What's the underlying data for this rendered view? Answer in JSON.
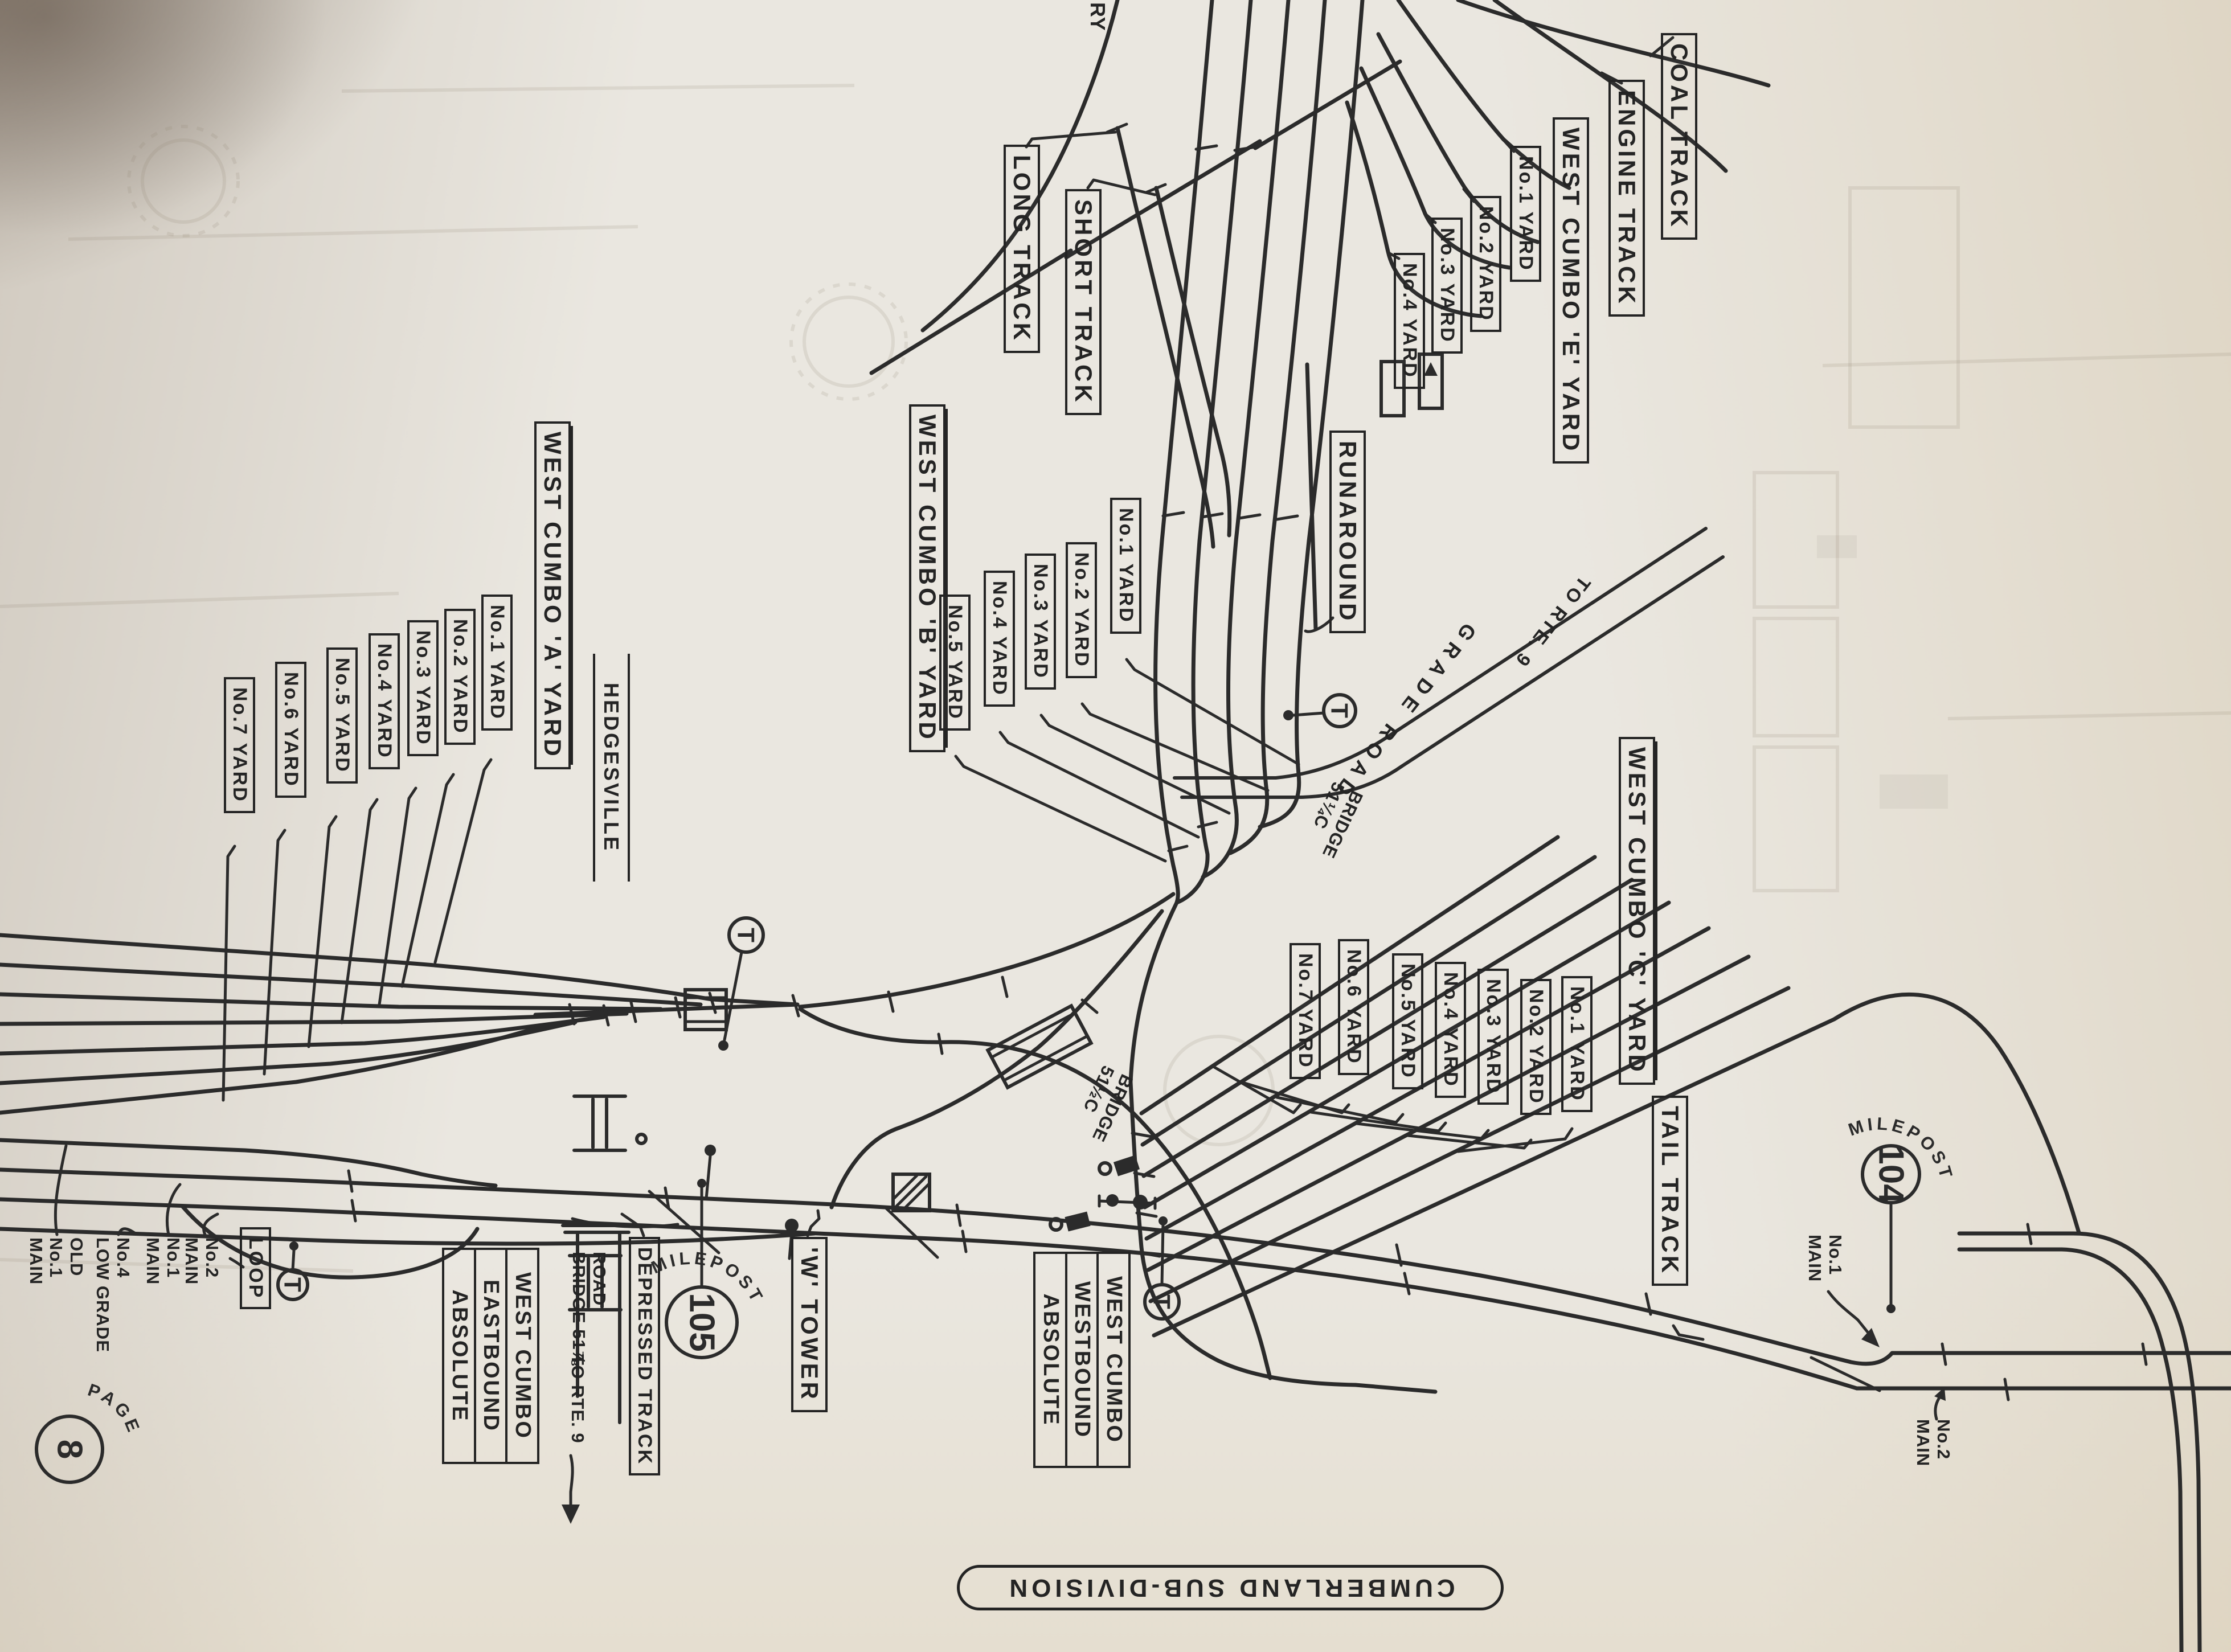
{
  "page": {
    "label": "PAGE",
    "number": "8",
    "banner": "CUMBERLAND SUB-DIVISION",
    "edge_fragment": "RY"
  },
  "symbols": {
    "telephone": "T"
  },
  "mileposts": {
    "mp104": {
      "label": "MILEPOST",
      "number": "104"
    },
    "mp105": {
      "label": "MILEPOST",
      "number": "105"
    }
  },
  "yards": {
    "a": {
      "title": "WEST CUMBO 'A' YARD",
      "tracks": [
        "No.1 YARD",
        "No.2 YARD",
        "No.3 YARD",
        "No.4 YARD",
        "No.5 YARD",
        "No.6 YARD",
        "No.7 YARD"
      ]
    },
    "b": {
      "title": "WEST CUMBO 'B' YARD",
      "tracks": [
        "No.1 YARD",
        "No.2 YARD",
        "No.3 YARD",
        "No.4 YARD",
        "No.5 YARD"
      ]
    },
    "c": {
      "title": "WEST CUMBO 'C' YARD",
      "tracks": [
        "No.1 YARD",
        "No.2 YARD",
        "No.3 YARD",
        "No.4 YARD",
        "No.5 YARD",
        "No.6 YARD",
        "No.7 YARD"
      ]
    },
    "e": {
      "title": "WEST CUMBO 'E' YARD",
      "tracks": [
        "No.1 YARD",
        "No.2 YARD",
        "No.3 YARD",
        "No.4 YARD"
      ]
    }
  },
  "tracks": {
    "coal": "COAL TRACK",
    "engine": "ENGINE TRACK",
    "long": "LONG TRACK",
    "short": "SHORT TRACK",
    "runaround": "RUNAROUND",
    "tail": "TAIL TRACK",
    "depressed": "DEPRESSED TRACK",
    "loop": "LOOP"
  },
  "stations": {
    "hedgesville": "HEDGESVILLE",
    "tower": "'W' TOWER"
  },
  "signals": {
    "westbound": {
      "l1": "WEST CUMBO",
      "l2": "WESTBOUND",
      "l3": "ABSOLUTE"
    },
    "eastbound": {
      "l1": "WEST CUMBO",
      "l2": "EASTBOUND",
      "l3": "ABSOLUTE"
    }
  },
  "mains": {
    "old_no1": {
      "l1": "OLD",
      "l2": "No.1",
      "l3": "MAIN"
    },
    "no4_low_grade": {
      "l1": "No.4",
      "l2": "LOW GRADE"
    },
    "no1_left": {
      "l1": "No.1",
      "l2": "MAIN"
    },
    "no2_left": {
      "l1": "No.2",
      "l2": "MAIN"
    },
    "no1_right": {
      "l1": "No.1",
      "l2": "MAIN"
    },
    "no2_right": {
      "l1": "No.2",
      "l2": "MAIN"
    }
  },
  "roads": {
    "grade_road": "GRADE ROAD",
    "to_rte9_grade": "TO RTE. 9",
    "road_label": {
      "l1": "ROAD",
      "l2": "BRIDGE 51⅞"
    },
    "to_rte9_bridge": "TO RTE. 9"
  },
  "bridges": {
    "b1": {
      "l1": "BRIDGE",
      "l2": "51¼C"
    },
    "b2": {
      "l1": "BRIDGE",
      "l2": "51½C"
    }
  }
}
